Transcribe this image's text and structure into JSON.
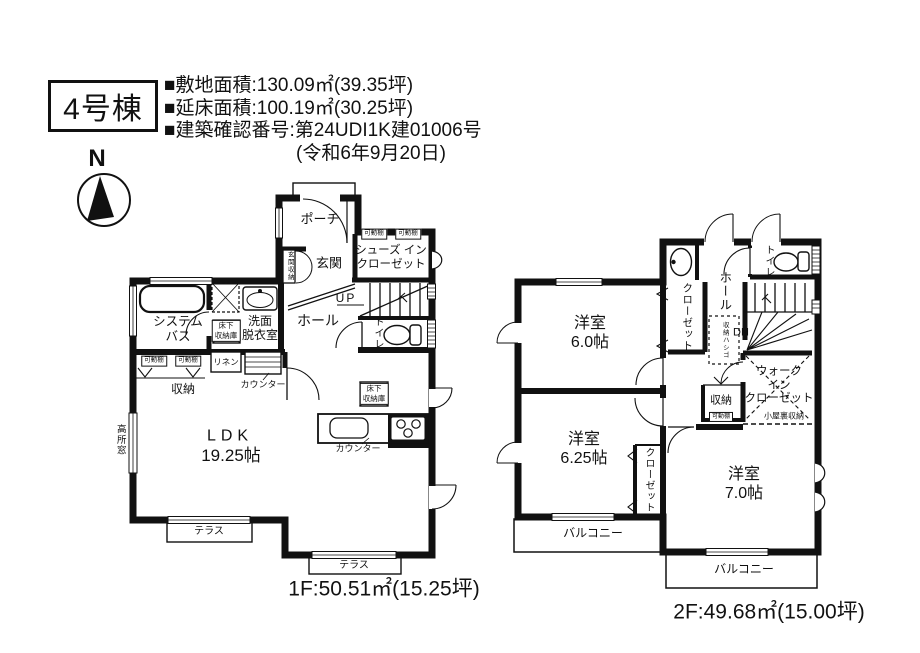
{
  "header": {
    "building_label": "4号棟",
    "site_area": "■敷地面積:130.09㎡(39.35坪)",
    "total_floor_area": "■延床面積:100.19㎡(30.25坪)",
    "building_confirmation": "■建築確認番号:第24UDI1K建01006号",
    "confirmation_date": "(令和6年9月20日)"
  },
  "compass": {
    "north_label": "N"
  },
  "floor1": {
    "caption": "1F:50.51㎡(15.25坪)",
    "labels": {
      "porch": "ポーチ",
      "entrance": "玄関",
      "entrance_storage": "玄関収納",
      "shoes_in_closet": "シューズ イン\nクローゼット",
      "movable_shelf": "可動棚",
      "up": "UP",
      "hall": "ホール",
      "toilet": "トイレ",
      "system_bath": "システム\nバス",
      "underfloor_storage": "床下\n収納庫",
      "washroom": "洗面\n脱衣室",
      "linen": "リネン",
      "storage": "収納",
      "counter": "カウンター",
      "high_window": "高所窓",
      "ldk_name": "LDK",
      "ldk_size": "19.25帖",
      "terrace": "テラス"
    }
  },
  "floor2": {
    "caption": "2F:49.68㎡(15.00坪)",
    "labels": {
      "toilet": "トイレ",
      "hall": "ホール",
      "closet": "クローゼット",
      "storage_ladder": "収納ハシゴ",
      "down": "DN",
      "walk_in_closet": "ウォーク\nイン\nクローゼット",
      "attic_storage": "小屋裏収納",
      "storage": "収納",
      "movable_shelf": "可動棚",
      "room_6_0": "洋室\n6.0帖",
      "room_6_25": "洋室\n6.25帖",
      "room_7_0": "洋室\n7.0帖",
      "balcony": "バルコニー"
    }
  }
}
